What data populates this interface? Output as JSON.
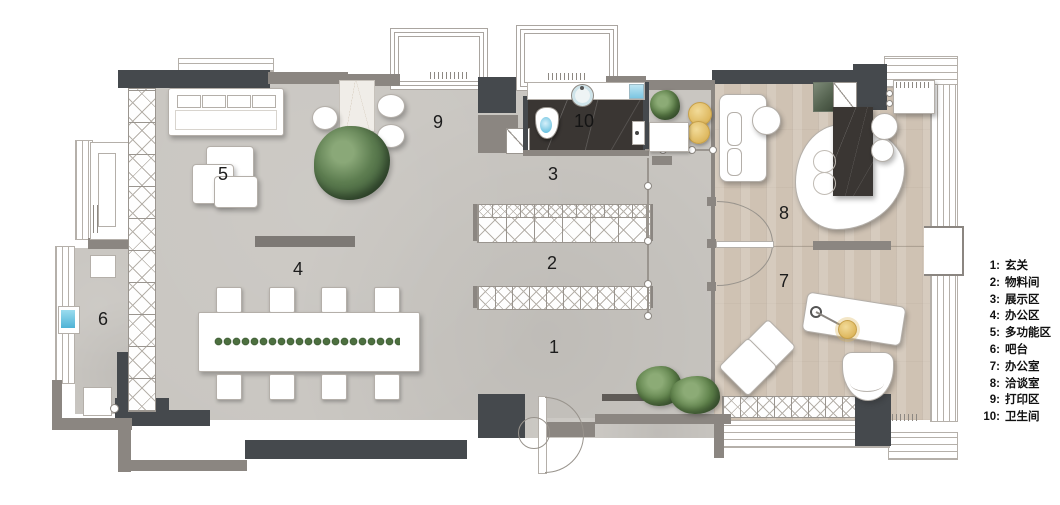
{
  "legend": {
    "items": [
      {
        "key": "1:",
        "label": "玄关"
      },
      {
        "key": "2:",
        "label": "物料间"
      },
      {
        "key": "3:",
        "label": "展示区"
      },
      {
        "key": "4:",
        "label": "办公区"
      },
      {
        "key": "5:",
        "label": "多功能区"
      },
      {
        "key": "6:",
        "label": "吧台"
      },
      {
        "key": "7:",
        "label": "办公室"
      },
      {
        "key": "8:",
        "label": "洽谈室"
      },
      {
        "key": "9:",
        "label": "打印区"
      },
      {
        "key": "10:",
        "label": "卫生间"
      }
    ]
  },
  "room_numbers": {
    "r1": "1",
    "r2": "2",
    "r3": "3",
    "r4": "4",
    "r5": "5",
    "r6": "6",
    "r7": "7",
    "r8": "8",
    "r9": "9",
    "r10": "10"
  },
  "colors": {
    "concrete_floor": "#c9c6c1",
    "wood_floor": "#cfc2b3",
    "dark_wall": "#45494d",
    "medium_wall": "#8b8681",
    "bathroom_marble": "#3a3633",
    "plant_green": "#5d7d50",
    "stool_gold": "#deb85f",
    "water_blue": "#7cc6e2"
  }
}
